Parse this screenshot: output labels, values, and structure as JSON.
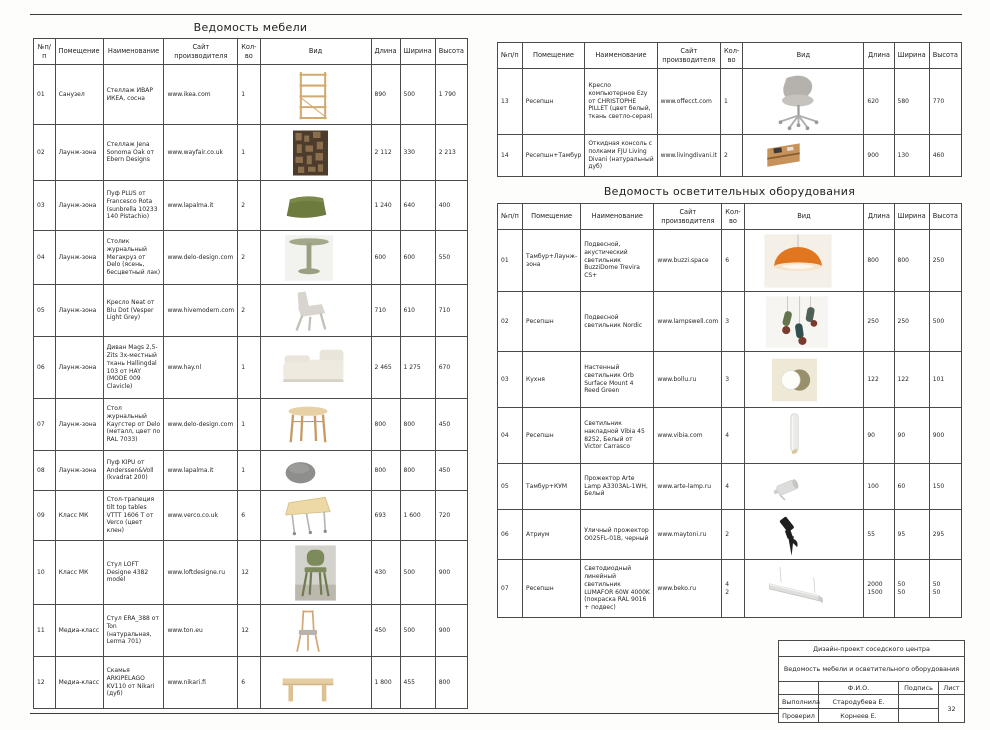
{
  "columns": {
    "no": "№п/п",
    "room": "Помещение",
    "name": "Наименование",
    "site": "Сайт производителя",
    "qty": "Кол-во",
    "view": "Вид",
    "length": "Длина",
    "width": "Ширина",
    "height": "Высота"
  },
  "furniture": {
    "title": "Ведомость мебели",
    "rows": [
      {
        "no": "01",
        "room": "Санузел",
        "name": "Стеллаж ИВАР ИКЕА, сосна",
        "site": "www.ikea.com",
        "qty": "1",
        "image": "shelf-ivar",
        "length": "890",
        "width": "500",
        "height": "1 790"
      },
      {
        "no": "02",
        "room": "Лаунж-зона",
        "name": "Стеллаж Jena Sonoma Oak от Ebern Designs",
        "site": "www.wayfair.co.uk",
        "qty": "1",
        "image": "wall-shelf",
        "length": "2 112",
        "width": "330",
        "height": "2 213"
      },
      {
        "no": "03",
        "room": "Лаунж-зона",
        "name": "Пуф PLUS от Francesco Rota (sunbrella 10233 140 Pistachio)",
        "site": "www.lapalma.it",
        "qty": "2",
        "image": "pouf-green",
        "length": "1 240",
        "width": "640",
        "height": "400"
      },
      {
        "no": "04",
        "room": "Лаунж-зона",
        "name": "Столик журнальный Мегакруз от Delo (ясень, бесцветный лак)",
        "site": "www.delo-design.com",
        "qty": "2",
        "image": "pedestal-table",
        "length": "600",
        "width": "600",
        "height": "550"
      },
      {
        "no": "05",
        "room": "Лаунж-зона",
        "name": "Кресло Neat от Blu Dot (Vesper Light Grey)",
        "site": "www.hivemodern.com",
        "qty": "2",
        "image": "lounge-chair",
        "length": "710",
        "width": "610",
        "height": "710"
      },
      {
        "no": "06",
        "room": "Лаунж-зона",
        "name": "Диван Mags 2,5-Zits 3х-местный ткань Hallingdal 103 от HAY (MODE 009 Clavicle)",
        "site": "www.hay.nl",
        "qty": "1",
        "image": "sofa",
        "length": "2 465",
        "width": "1 275",
        "height": "670"
      },
      {
        "no": "07",
        "room": "Лаунж-зона",
        "name": "Стол журнальный Каугстер от Delo (металл, цвет по RAL 7033)",
        "site": "www.delo-design.com",
        "qty": "1",
        "image": "wood-table",
        "length": "800",
        "width": "800",
        "height": "450"
      },
      {
        "no": "08",
        "room": "Лаунж-зона",
        "name": "Пуф KIPU от Anderssen&Voll (kvadrat 200)",
        "site": "www.lapalma.it",
        "qty": "1",
        "image": "pouf-grey",
        "length": "800",
        "width": "800",
        "height": "450"
      },
      {
        "no": "09",
        "room": "Класс МК",
        "name": "Стол-трапеция tilt top tables VTTT 1606 T от Verco (цвет клен)",
        "site": "www.verco.co.uk",
        "qty": "6",
        "image": "flip-table",
        "length": "693",
        "width": "1 600",
        "height": "720"
      },
      {
        "no": "10",
        "room": "Класс МК",
        "name": "Стул LOFT Designe 4382 model",
        "site": "www.loftdesigne.ru",
        "qty": "12",
        "image": "chair-green",
        "length": "430",
        "width": "500",
        "height": "900"
      },
      {
        "no": "11",
        "room": "Медиа-класс",
        "name": "Стул ERA_388 от Ton (натуральная, Lerma 701)",
        "site": "www.ton.eu",
        "qty": "12",
        "image": "chair-wood",
        "length": "450",
        "width": "500",
        "height": "900"
      },
      {
        "no": "12",
        "room": "Медиа-класс",
        "name": "Скамья ARKIPELAGO KV110 от Nikari (дуб)",
        "site": "www.nikari.fi",
        "qty": "6",
        "image": "bench",
        "length": "1 800",
        "width": "455",
        "height": "800"
      }
    ]
  },
  "furniture_cont": {
    "rows": [
      {
        "no": "13",
        "room": "Ресепшн",
        "name": "Кресло компьютерное Ezy от CHRISTOPHE PILLET (цвет белый, ткань светло-серая)",
        "site": "www.offecct.com",
        "qty": "1",
        "image": "office-chair",
        "length": "620",
        "width": "580",
        "height": "770"
      },
      {
        "no": "14",
        "room": "Ресепшн+Тамбур",
        "name": "Откидная консоль с полками FJU Living Divani (натуральный дуб)",
        "site": "www.livingdivani.it",
        "qty": "2",
        "image": "wall-console",
        "length": "900",
        "width": "130",
        "height": "460"
      }
    ]
  },
  "lighting": {
    "title": "Ведомость осветительных оборудования",
    "rows": [
      {
        "no": "01",
        "room": "Тамбур+Лаунж-зона",
        "name": "Подвесной, акустический светильник BuzziDome Trevira CS+",
        "site": "www.buzzi.space",
        "qty": "6",
        "image": "dome-pendant",
        "length": "800",
        "width": "800",
        "height": "250"
      },
      {
        "no": "02",
        "room": "Ресепшн",
        "name": "Подвесной светильник Nordic",
        "site": "www.lampswell.com",
        "qty": "3",
        "image": "cluster-pendant",
        "length": "250",
        "width": "250",
        "height": "500"
      },
      {
        "no": "03",
        "room": "Кухня",
        "name": "Настенный светильник Orb Surface Mount 4 Reed Green",
        "site": "www.bollu.ru",
        "qty": "3",
        "image": "orb-sconce",
        "length": "122",
        "width": "122",
        "height": "101"
      },
      {
        "no": "04",
        "room": "Ресепшн",
        "name": "Светильник накладной Vibia 45 8252, Белый от Victor Carrasco",
        "site": "www.vibia.com",
        "qty": "4",
        "image": "tube-light",
        "length": "90",
        "width": "90",
        "height": "900"
      },
      {
        "no": "05",
        "room": "Тамбур+КУМ",
        "name": "Прожектор Arte Lamp A3303AL-1WH, Белый",
        "site": "www.arte-lamp.ru",
        "qty": "4",
        "image": "spot-white",
        "length": "100",
        "width": "60",
        "height": "150"
      },
      {
        "no": "06",
        "room": "Атриум",
        "name": "Уличный прожектор O025FL-01B, черный",
        "site": "www.maytoni.ru",
        "qty": "2",
        "image": "spike-light",
        "length": "55",
        "width": "95",
        "height": "295"
      },
      {
        "no": "07",
        "room": "Ресепшн",
        "name": "Светодиодный линейный светильник LUMAFOR 60W 4000K (покраска RAL 9016 + подвес)",
        "site": "www.beko.ru",
        "qty": "4\n2",
        "image": "linear-light",
        "length": "2000\n1500",
        "width": "50\n50",
        "height": "50\n50"
      }
    ]
  },
  "title_block": {
    "project": "Дизайн-проект соседского центра",
    "doc_title": "Ведомость мебели и осветительного оборудования",
    "fio_label": "Ф.И.О.",
    "sign_label": "Подпись",
    "sheet_label": "Лист",
    "made_label": "Выполнила",
    "made_name": "Стародубева Е.",
    "checked_label": "Проверил",
    "checked_name": "Корнеев Е.",
    "sheet_number": "32"
  }
}
